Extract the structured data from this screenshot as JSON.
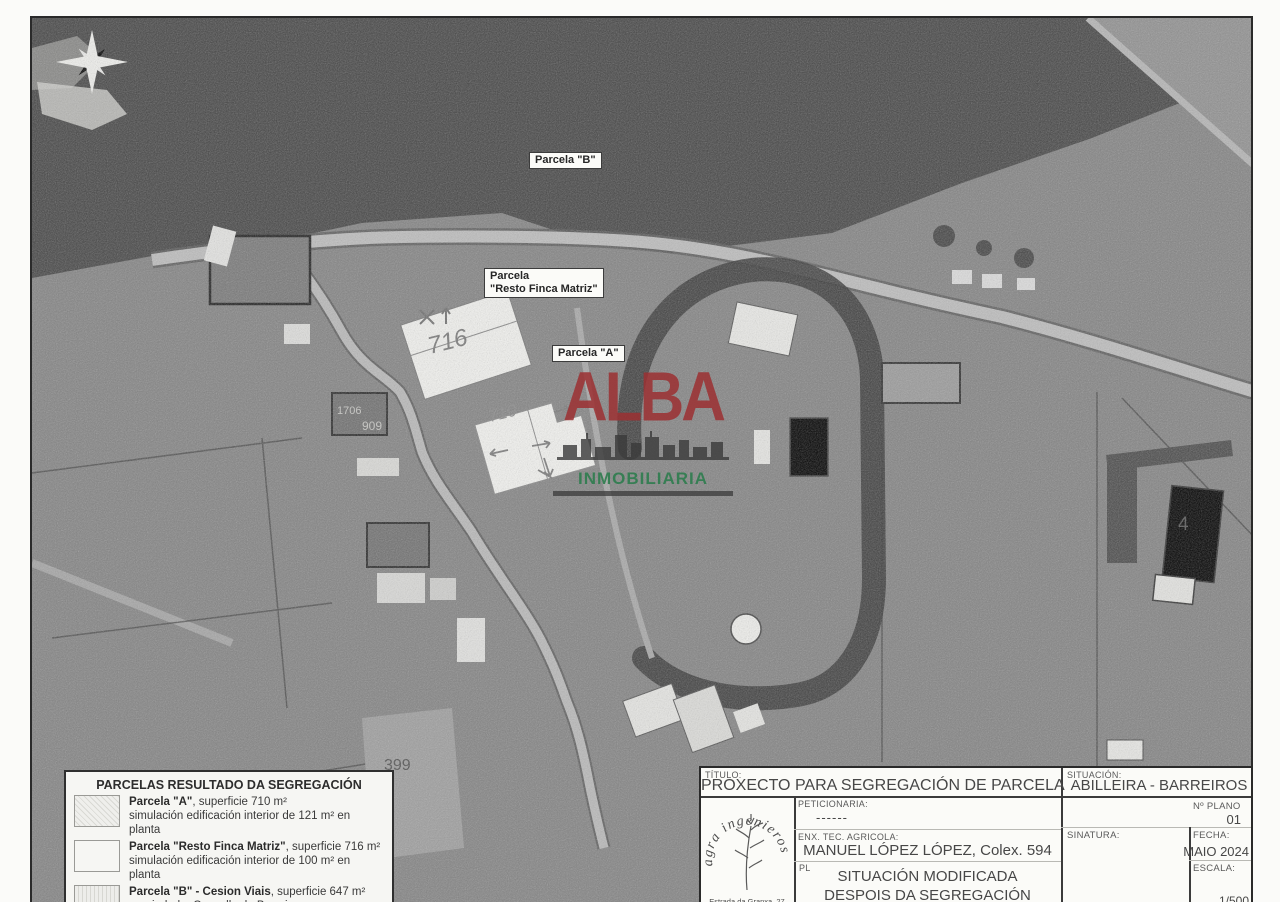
{
  "map": {
    "labels": {
      "parcela_b": "Parcela \"B\"",
      "parcela_resto_line1": "Parcela",
      "parcela_resto_line2": "\"Resto Finca Matriz\"",
      "parcela_a": "Parcela \"A\""
    },
    "annotations": {
      "handwritten_resto_area": "716",
      "handwritten_a_area": "710",
      "plot_399": "399",
      "plot_909": "909",
      "plot_1706": "1706",
      "building_4": "4"
    }
  },
  "watermark": {
    "line1": "ALBA",
    "line2": "INMOBILIARIA",
    "color_line1": "#9c3032",
    "color_line2": "#2e7d4e"
  },
  "legend": {
    "title": "PARCELAS RESULTADO DA SEGREGACIÓN",
    "entries": [
      {
        "name": "Parcela \"A\"",
        "detail": ", superficie 710 m²",
        "sub": "simulación edificación interior de 121 m² en planta"
      },
      {
        "name": "Parcela \"Resto Finca Matriz\"",
        "detail": ", superficie 716 m²",
        "sub": "simulación edificación interior de 100 m² en planta"
      },
      {
        "name": "Parcela \"B\" - Cesion Viais",
        "detail": ", superficie 647 m²",
        "sub": "propiedade: Concello de Barreiros"
      }
    ]
  },
  "title_block": {
    "titulo_label": "TÍTULO:",
    "titulo": "PROXECTO PARA SEGREGACIÓN DE PARCELA",
    "situacion_label": "SITUACIÓN:",
    "situacion": "ABILLEIRA - BARREIROS",
    "logo_name": "agra ingenieros",
    "logo_address": "Estrada da Granxa, 27",
    "peticionaria_label": "PETICIONARIA:",
    "peticionaria_value": "------",
    "num_plano_label": "Nº PLANO",
    "num_plano_value": "01",
    "enx_label": "ENX. TEC. AGRICOLA:",
    "enx_value": "MANUEL LÓPEZ LÓPEZ,  Colex. 594",
    "sinatura_label": "SINATURA:",
    "fecha_label": "FECHA:",
    "fecha_value": "MAIO 2024",
    "plano_label": "PL",
    "plano_line1": "SITUACIÓN MODIFICADA",
    "plano_line2": "DESPOIS DA SEGREGACIÓN",
    "escala_label": "ESCALA:",
    "escala_value": "1/500"
  }
}
